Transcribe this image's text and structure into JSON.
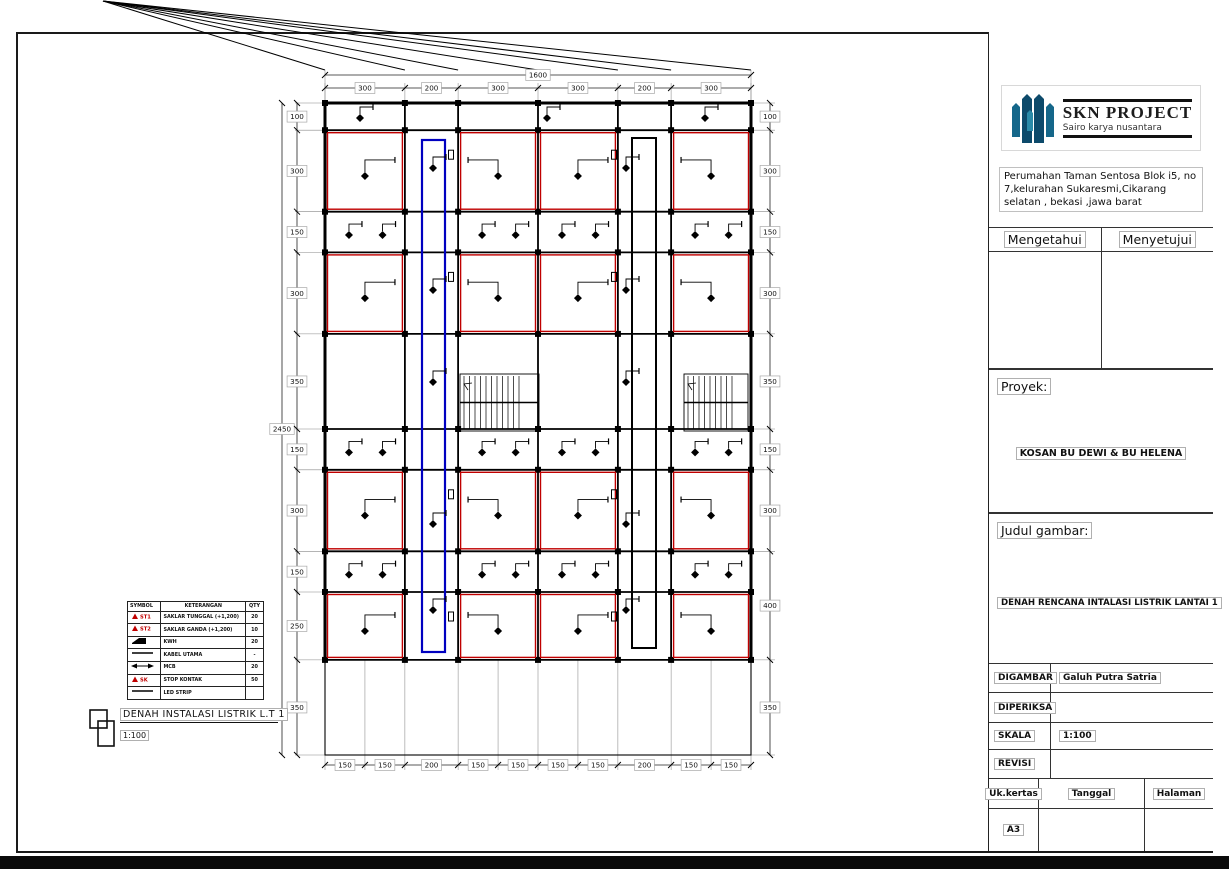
{
  "title_block": {
    "logo": {
      "name": "SKN PROJECT",
      "tagline": "Sairo karya nusantara",
      "accent": "#15678a",
      "accent_dark": "#0d4a6b"
    },
    "address": "Perumahan Taman Sentosa Blok i5, no 7,kelurahan Sukaresmi,Cikarang selatan , bekasi ,jawa barat",
    "approval_left": "Mengetahui",
    "approval_right": "Menyetujui",
    "proyek_label": "Proyek:",
    "proyek_value": "KOSAN BU DEWI & BU HELENA",
    "judul_label": "Judul gambar:",
    "judul_value": "DENAH RENCANA INTALASI LISTRIK LANTAI 1",
    "info_rows": [
      {
        "label": "DIGAMBAR",
        "value": "Galuh Putra Satria"
      },
      {
        "label": "DIPERIKSA",
        "value": ""
      },
      {
        "label": "SKALA",
        "value": "1:100"
      },
      {
        "label": "REVISI",
        "value": ""
      }
    ],
    "paper_label": "Uk.kertas",
    "date_label": "Tanggal",
    "page_label": "Halaman",
    "paper_value": "A3"
  },
  "drawing": {
    "title": "DENAH INSTALASI LISTRIK L.T 1",
    "scale": "1:100",
    "colors": {
      "wall": "#000000",
      "circuit": "#c00000",
      "riser_left": "#0000c0",
      "riser_right": "#000000"
    },
    "dimensions": {
      "top_overall": "1600",
      "top": [
        "300",
        "200",
        "300",
        "300",
        "200",
        "300"
      ],
      "left_overall": "2450",
      "left": [
        "100",
        "300",
        "150",
        "300",
        "350",
        "150",
        "300",
        "150",
        "250",
        "350"
      ],
      "right": [
        "100",
        "300",
        "150",
        "300",
        "350",
        "150",
        "300",
        "400",
        "350"
      ],
      "bottom": [
        "150",
        "150",
        "200",
        "150",
        "150",
        "150",
        "150",
        "200",
        "150",
        "150"
      ]
    },
    "legend": {
      "headers": [
        "SYMBOL",
        "KETERANGAN",
        "QTY"
      ],
      "rows": [
        {
          "symbol": "triangle",
          "code": "ST1",
          "label": "SAKLAR TUNGGAL (+1,200)",
          "qty": "20"
        },
        {
          "symbol": "triangle",
          "code": "ST2",
          "label": "SAKLAR GANDA (+1,200)",
          "qty": "10"
        },
        {
          "symbol": "kwh",
          "code": "",
          "label": "KWH",
          "qty": "20"
        },
        {
          "symbol": "line",
          "code": "",
          "label": "KABEL UTAMA",
          "qty": "-"
        },
        {
          "symbol": "mcb",
          "code": "",
          "label": "MCB",
          "qty": "20"
        },
        {
          "symbol": "triangle",
          "code": "SK",
          "label": "STOP KONTAK",
          "qty": "50"
        },
        {
          "symbol": "line",
          "code": "",
          "label": "LED STRIP",
          "qty": ""
        }
      ]
    },
    "plan": {
      "cols_cm": [
        300,
        200,
        300,
        300,
        200,
        300
      ],
      "rows_cm": [
        100,
        300,
        150,
        300,
        350,
        150,
        300,
        150,
        250,
        350
      ]
    }
  }
}
